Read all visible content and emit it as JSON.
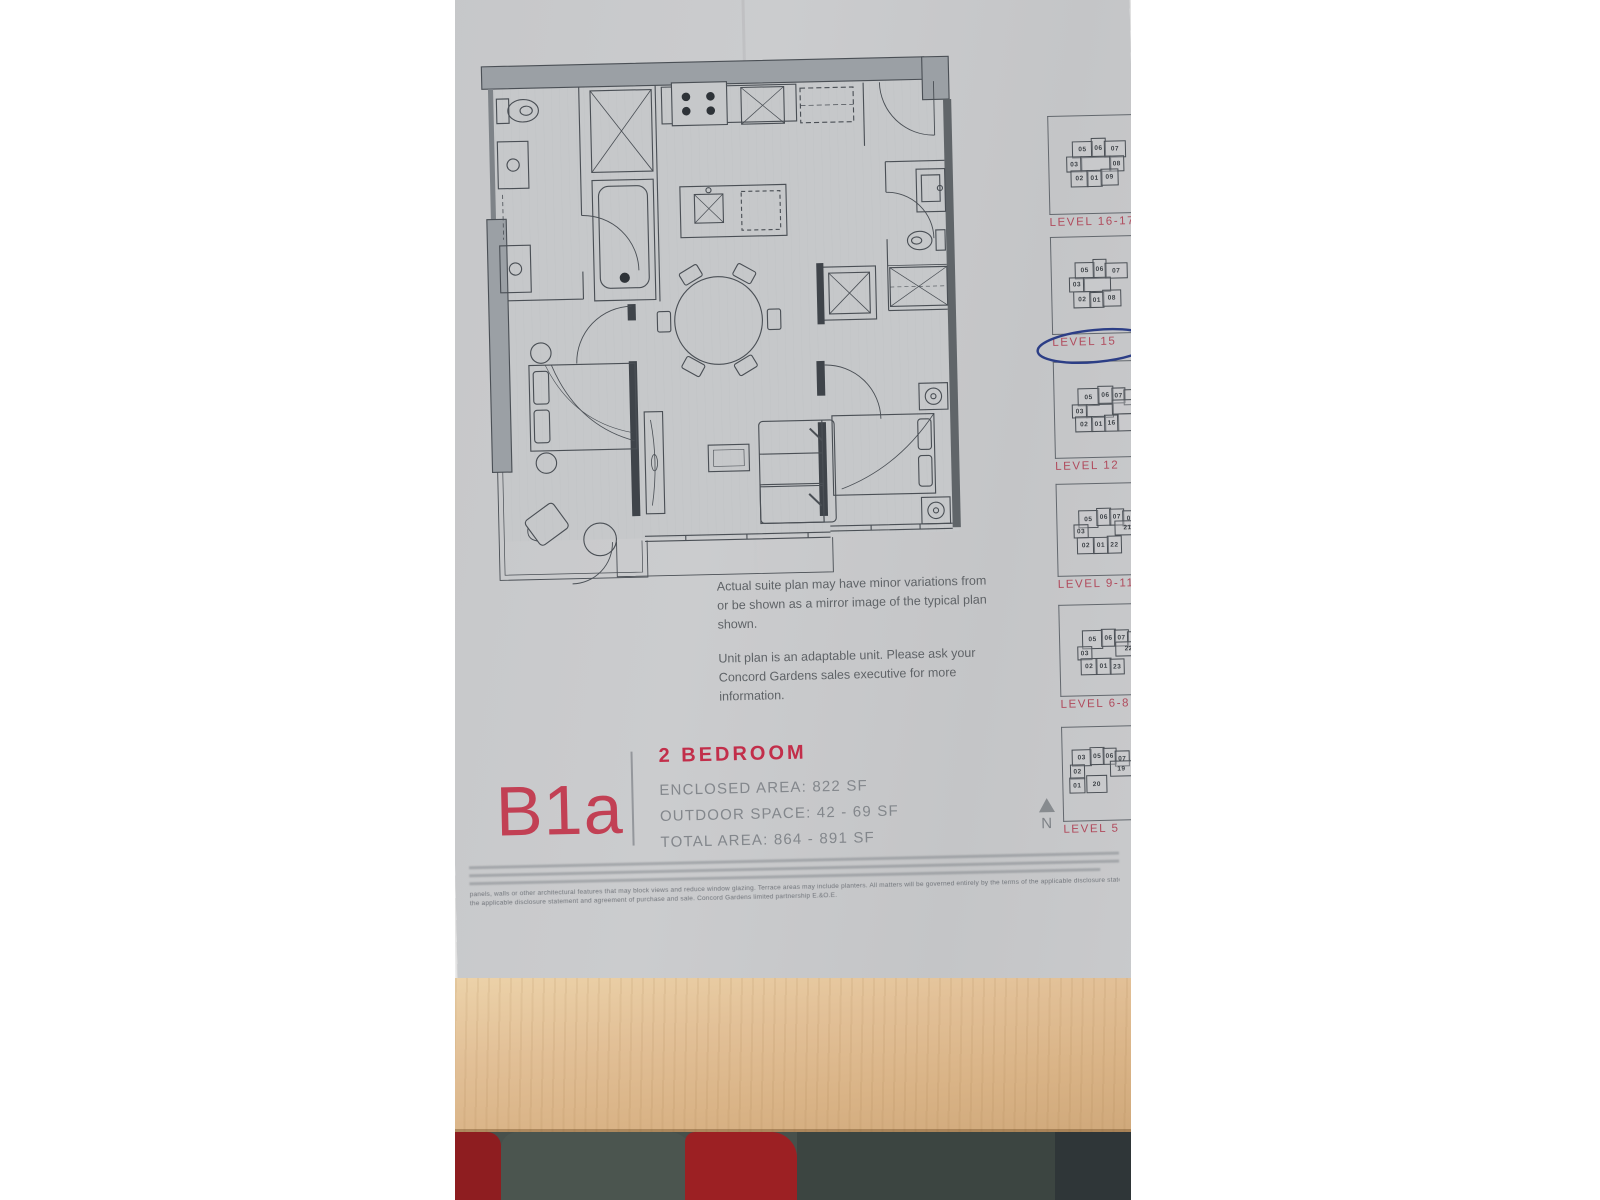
{
  "page": {
    "description": "Photographed brochure page of a Concord Gardens condominium floor plan lying on a wooden table"
  },
  "plan_code": "B1a",
  "unit": {
    "heading": "2 BEDROOM",
    "specs": [
      "ENCLOSED AREA: 822 SF",
      "OUTDOOR SPACE: 42 - 69 SF",
      "TOTAL AREA: 864 - 891 SF"
    ]
  },
  "notes": {
    "para1": "Actual suite plan may have minor variations from or be shown as a mirror image of the typical plan shown.",
    "para2": "Unit plan is an adaptable unit. Please ask your Concord Gardens sales executive for more information."
  },
  "compass": {
    "label": "N"
  },
  "levels": [
    {
      "label": "LEVEL 16-17",
      "circled": false,
      "box": {
        "top": 134,
        "height": 97
      },
      "units": [
        {
          "label": "05",
          "x": 11,
          "y": 3,
          "w": 19,
          "h": 15
        },
        {
          "label": "06",
          "x": 30,
          "y": 0,
          "w": 13,
          "h": 18
        },
        {
          "label": "07",
          "x": 43,
          "y": 3,
          "w": 20,
          "h": 15
        },
        {
          "label": "03",
          "x": 5,
          "y": 18,
          "w": 14,
          "h": 14
        },
        {
          "label": "",
          "x": 19,
          "y": 18,
          "w": 29,
          "h": 14
        },
        {
          "label": "08",
          "x": 48,
          "y": 18,
          "w": 13,
          "h": 14
        },
        {
          "label": "02",
          "x": 9,
          "y": 32,
          "w": 16,
          "h": 15
        },
        {
          "label": "01",
          "x": 25,
          "y": 32,
          "w": 14,
          "h": 15
        },
        {
          "label": "09",
          "x": 39,
          "y": 31,
          "w": 16,
          "h": 15
        }
      ]
    },
    {
      "label": "LEVEL 15",
      "circled": true,
      "box": {
        "top": 255,
        "height": 96
      },
      "units": [
        {
          "label": "05",
          "x": 11,
          "y": 3,
          "w": 18,
          "h": 15
        },
        {
          "label": "06",
          "x": 29,
          "y": 0,
          "w": 12,
          "h": 18
        },
        {
          "label": "07",
          "x": 41,
          "y": 4,
          "w": 21,
          "h": 14
        },
        {
          "label": "03",
          "x": 5,
          "y": 18,
          "w": 14,
          "h": 13
        },
        {
          "label": "",
          "x": 19,
          "y": 18,
          "w": 26,
          "h": 13
        },
        {
          "label": "02",
          "x": 9,
          "y": 32,
          "w": 16,
          "h": 15
        },
        {
          "label": "01",
          "x": 25,
          "y": 33,
          "w": 13,
          "h": 14
        },
        {
          "label": "08",
          "x": 38,
          "y": 31,
          "w": 17,
          "h": 15
        }
      ]
    },
    {
      "label": "LEVEL 12",
      "circled": false,
      "box": {
        "top": 380,
        "height": 95
      },
      "units": [
        {
          "label": "05",
          "x": 11,
          "y": 4,
          "w": 20,
          "h": 16
        },
        {
          "label": "06",
          "x": 31,
          "y": 2,
          "w": 14,
          "h": 16
        },
        {
          "label": "07",
          "x": 45,
          "y": 4,
          "w": 12,
          "h": 14
        },
        {
          "label": "",
          "x": 57,
          "y": 6,
          "w": 14,
          "h": 14
        },
        {
          "label": "03",
          "x": 5,
          "y": 20,
          "w": 14,
          "h": 12
        },
        {
          "label": "",
          "x": 19,
          "y": 20,
          "w": 26,
          "h": 12
        },
        {
          "label": "",
          "x": 45,
          "y": 16,
          "w": 25,
          "h": 13
        },
        {
          "label": "02",
          "x": 8,
          "y": 32,
          "w": 16,
          "h": 14
        },
        {
          "label": "01",
          "x": 24,
          "y": 32,
          "w": 13,
          "h": 14
        },
        {
          "label": "16",
          "x": 37,
          "y": 31,
          "w": 13,
          "h": 15
        },
        {
          "label": "",
          "x": 50,
          "y": 30,
          "w": 20,
          "h": 16
        }
      ]
    },
    {
      "label": "LEVEL 9-11",
      "circled": false,
      "box": {
        "top": 502,
        "height": 91
      },
      "units": [
        {
          "label": "05",
          "x": 9,
          "y": 4,
          "w": 18,
          "h": 16
        },
        {
          "label": "06",
          "x": 27,
          "y": 2,
          "w": 13,
          "h": 16
        },
        {
          "label": "07",
          "x": 40,
          "y": 3,
          "w": 13,
          "h": 15
        },
        {
          "label": "08",
          "x": 53,
          "y": 5,
          "w": 15,
          "h": 14
        },
        {
          "label": "03",
          "x": 4,
          "y": 18,
          "w": 13,
          "h": 12
        },
        {
          "label": "21",
          "x": 45,
          "y": 15,
          "w": 24,
          "h": 13
        },
        {
          "label": "02",
          "x": 7,
          "y": 31,
          "w": 16,
          "h": 15
        },
        {
          "label": "01",
          "x": 23,
          "y": 31,
          "w": 14,
          "h": 15
        },
        {
          "label": "22",
          "x": 37,
          "y": 30,
          "w": 13,
          "h": 16
        }
      ]
    },
    {
      "label": "LEVEL 6-8",
      "circled": false,
      "box": {
        "top": 623,
        "height": 90
      },
      "units": [
        {
          "label": "05",
          "x": 10,
          "y": 3,
          "w": 19,
          "h": 17
        },
        {
          "label": "06",
          "x": 29,
          "y": 2,
          "w": 13,
          "h": 16
        },
        {
          "label": "07",
          "x": 42,
          "y": 3,
          "w": 13,
          "h": 15
        },
        {
          "label": "08",
          "x": 55,
          "y": 5,
          "w": 15,
          "h": 14
        },
        {
          "label": "03",
          "x": 5,
          "y": 19,
          "w": 13,
          "h": 12
        },
        {
          "label": "22",
          "x": 43,
          "y": 15,
          "w": 25,
          "h": 13
        },
        {
          "label": "02",
          "x": 8,
          "y": 31,
          "w": 15,
          "h": 15
        },
        {
          "label": "01",
          "x": 23,
          "y": 31,
          "w": 14,
          "h": 15
        },
        {
          "label": "23",
          "x": 37,
          "y": 32,
          "w": 13,
          "h": 14
        }
      ]
    },
    {
      "label": "LEVEL 5",
      "circled": false,
      "box": {
        "top": 745,
        "height": 93
      },
      "units": [
        {
          "label": "03",
          "x": 3,
          "y": 4,
          "w": 18,
          "h": 15
        },
        {
          "label": "05",
          "x": 21,
          "y": 2,
          "w": 13,
          "h": 16
        },
        {
          "label": "06",
          "x": 34,
          "y": 3,
          "w": 12,
          "h": 15
        },
        {
          "label": "07",
          "x": 46,
          "y": 6,
          "w": 13,
          "h": 14
        },
        {
          "label": "02",
          "x": 1,
          "y": 19,
          "w": 13,
          "h": 13
        },
        {
          "label": "19",
          "x": 41,
          "y": 16,
          "w": 21,
          "h": 14
        },
        {
          "label": "01",
          "x": 0,
          "y": 32,
          "w": 14,
          "h": 14
        },
        {
          "label": "20",
          "x": 17,
          "y": 30,
          "w": 19,
          "h": 16
        }
      ]
    }
  ],
  "fine_print": {
    "legible_lines": [
      "panels, walls or other architectural features that may block views and reduce window glazing. Terrace areas may include planters. All matters will be governed entirely by the terms of the applicable disclosure statement and purchase contract in each case.",
      "the applicable disclosure statement and agreement of purchase and sale. Concord Gardens limited partnership E.&O.E."
    ]
  },
  "colors": {
    "accent_red": "#c22e4a",
    "level_label_red": "#b04a5c",
    "pen_blue": "#2c3e86",
    "paper_gray": "#c8c9cb",
    "wood": "#ddb88c"
  }
}
